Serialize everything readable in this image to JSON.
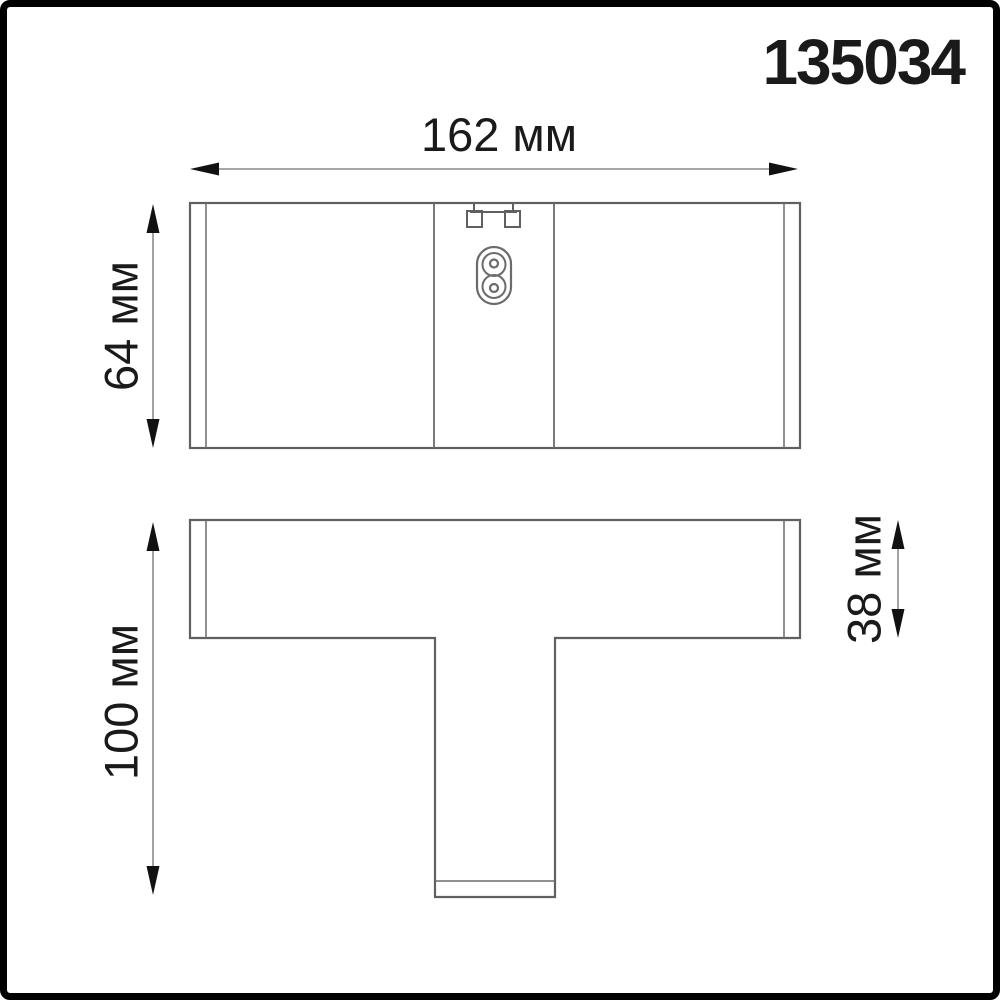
{
  "article_number": "135034",
  "colors": {
    "background": "#ffffff",
    "frame_border": "#000000",
    "drawing_outline": "#5f6062",
    "dimension_line": "#8a8a8a",
    "arrowhead": "#111111",
    "text": "#1a1a1a"
  },
  "views": {
    "front": {
      "width_dimension": {
        "label": "162 мм",
        "value": 162,
        "unit": "мм"
      },
      "height_dimension": {
        "label": "64 мм",
        "value": 64,
        "unit": "мм"
      }
    },
    "side": {
      "overall_height_dimension": {
        "label": "100 мм",
        "value": 100,
        "unit": "мм"
      },
      "bar_height_dimension": {
        "label": "38 мм",
        "value": 38,
        "unit": "мм"
      }
    }
  }
}
